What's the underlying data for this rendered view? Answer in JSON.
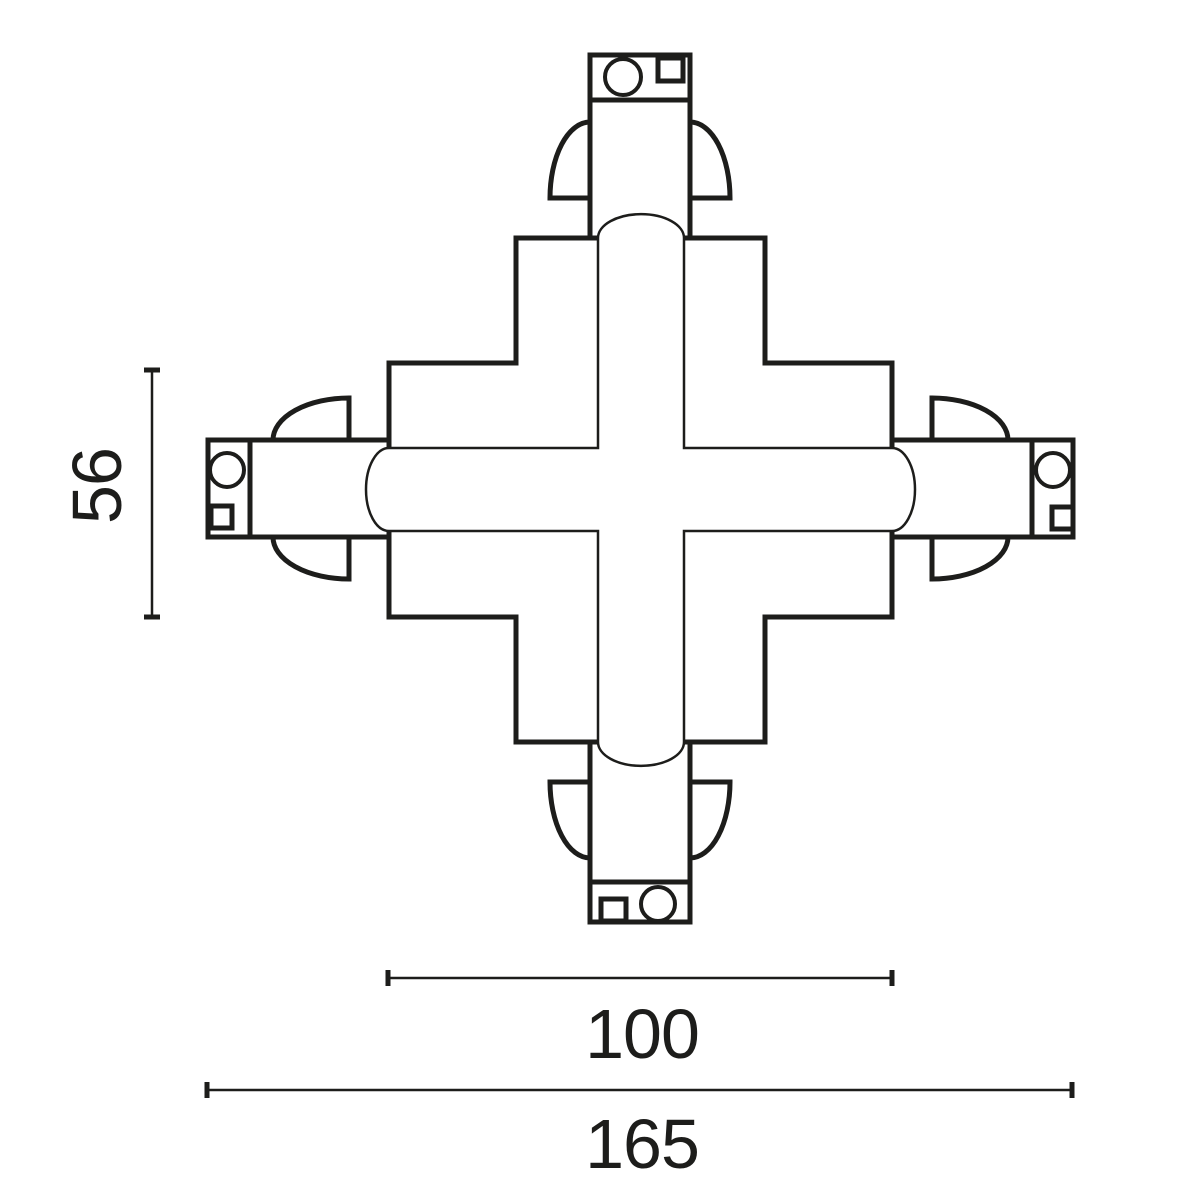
{
  "page": {
    "background": "#ffffff"
  },
  "drawing": {
    "ink_color": "#1d1d1b",
    "dimensions": {
      "depth": {
        "label": "56"
      },
      "body_width": {
        "label": "100"
      },
      "overall_width": {
        "label": "165"
      }
    }
  }
}
